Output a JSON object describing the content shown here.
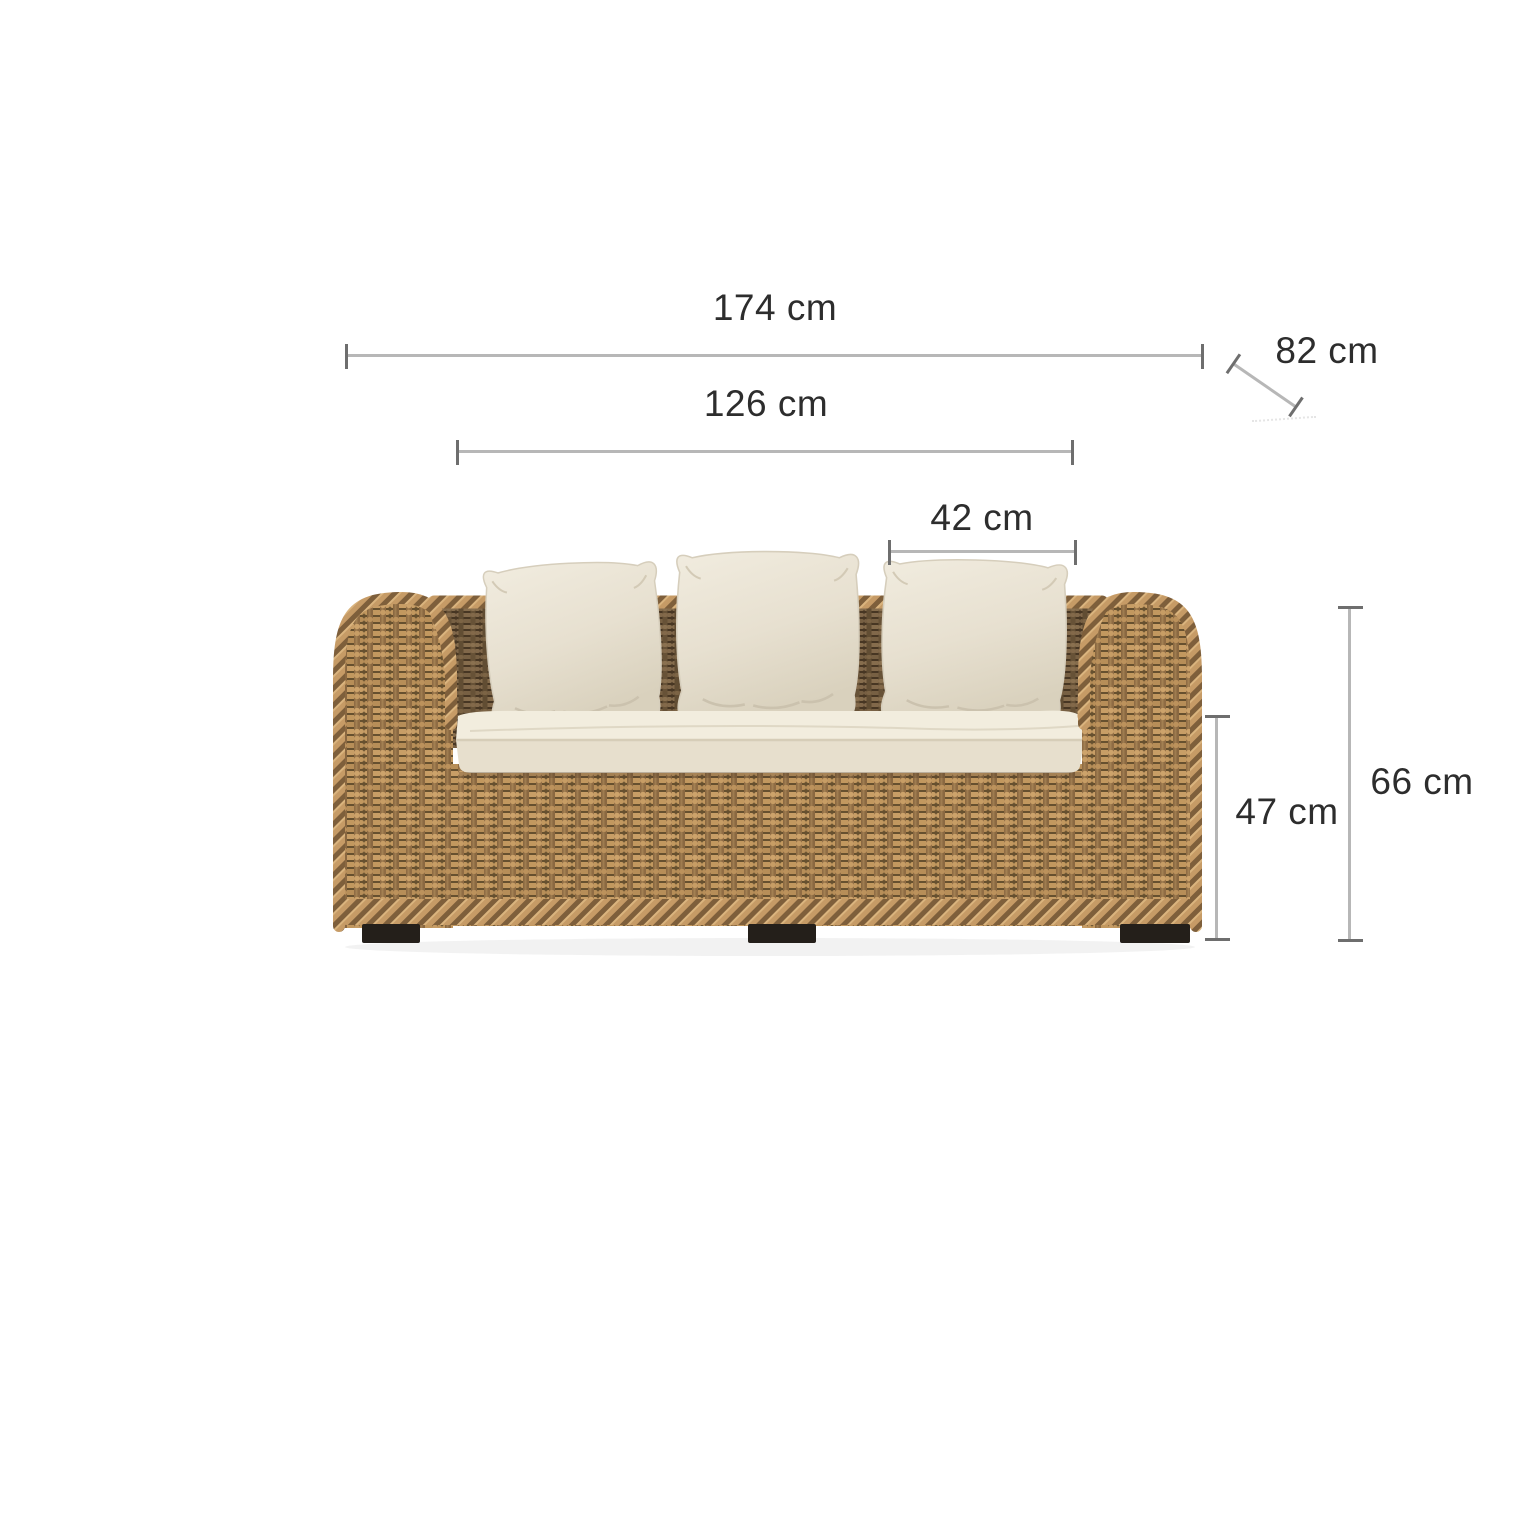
{
  "figure": {
    "alt_text": "Natural rattan two-seat sofa with three cream cushions, shown with dimension lines"
  },
  "dimensions": {
    "total_width": "174 cm",
    "seat_width": "126 cm",
    "cushion_width": "42 cm",
    "depth": "82 cm",
    "total_height": "66 cm",
    "seat_height": "47 cm"
  },
  "colors": {
    "background": "#ffffff",
    "text": "#2d2d2d",
    "line": "#b7b7b7",
    "tick": "#6e6e6e",
    "rattan_light": "#c89e66",
    "rattan_mid": "#8a6841",
    "rattan_dark": "#66502f",
    "back_weave": "#5a4730",
    "cushion": "#e9e2d2",
    "foot": "#241f1a"
  }
}
